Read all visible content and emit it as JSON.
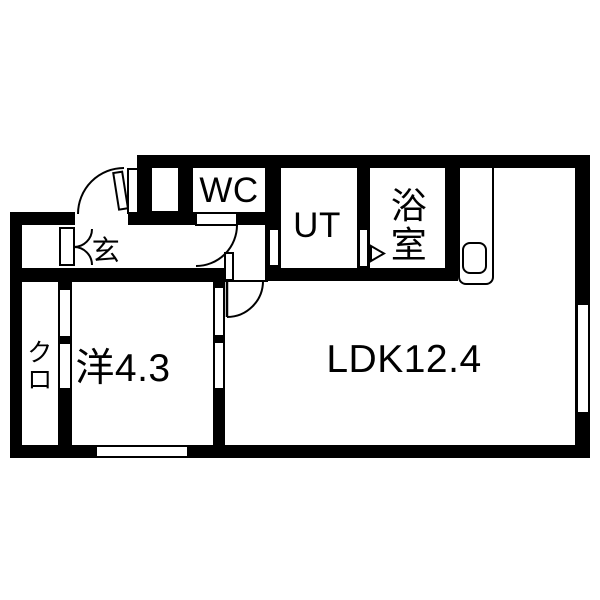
{
  "plan": {
    "type": "apartment-floor-plan",
    "rooms": {
      "ldk": {
        "label": "LDK12.4"
      },
      "western_room": {
        "label": "洋4.3"
      },
      "closet": {
        "label": "クロ",
        "char1": "ク",
        "char2": "ロ"
      },
      "entrance": {
        "label": "玄"
      },
      "wc": {
        "label": "WC"
      },
      "utility": {
        "label": "UT"
      },
      "bath": {
        "label": "浴室",
        "char1": "浴",
        "char2": "室"
      }
    },
    "colors": {
      "wall": "#000000",
      "floor": "#ffffff",
      "line": "#000000"
    }
  }
}
